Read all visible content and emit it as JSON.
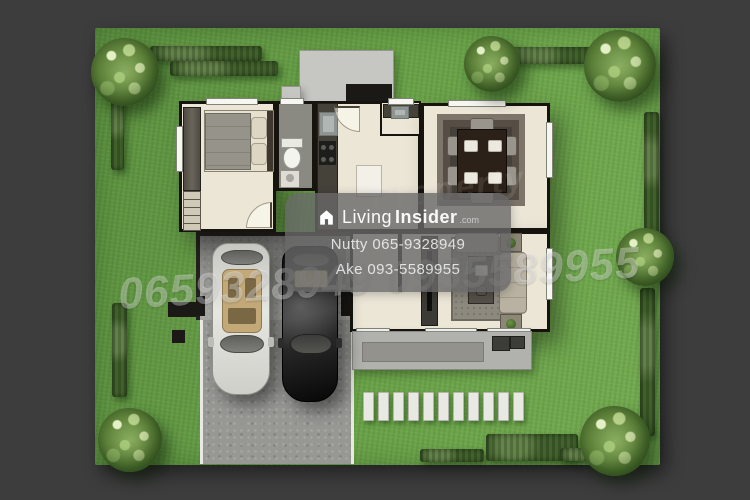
{
  "watermark": {
    "brand_light": "Living",
    "brand_bold": "Insider",
    "brand_suffix": ".com",
    "contact_line1": "Nutty 065-9328949",
    "contact_line2": "Ake 093-5589955",
    "diagonal_numbers": "0659328949 0935589955",
    "faint_text": "Property"
  },
  "palette": {
    "background": "#3d3d3d",
    "grass": "#67a046",
    "hedge": "#42632c",
    "floor": "#ece6d7",
    "wall": "#17140f",
    "concrete_pad": "#c6c6c3",
    "asphalt": "#979794",
    "badge": "rgba(104,104,104,0.80)"
  },
  "scene": {
    "trees_visible": 6,
    "stepping_stones_visible": 11,
    "cars_visible": 2
  }
}
